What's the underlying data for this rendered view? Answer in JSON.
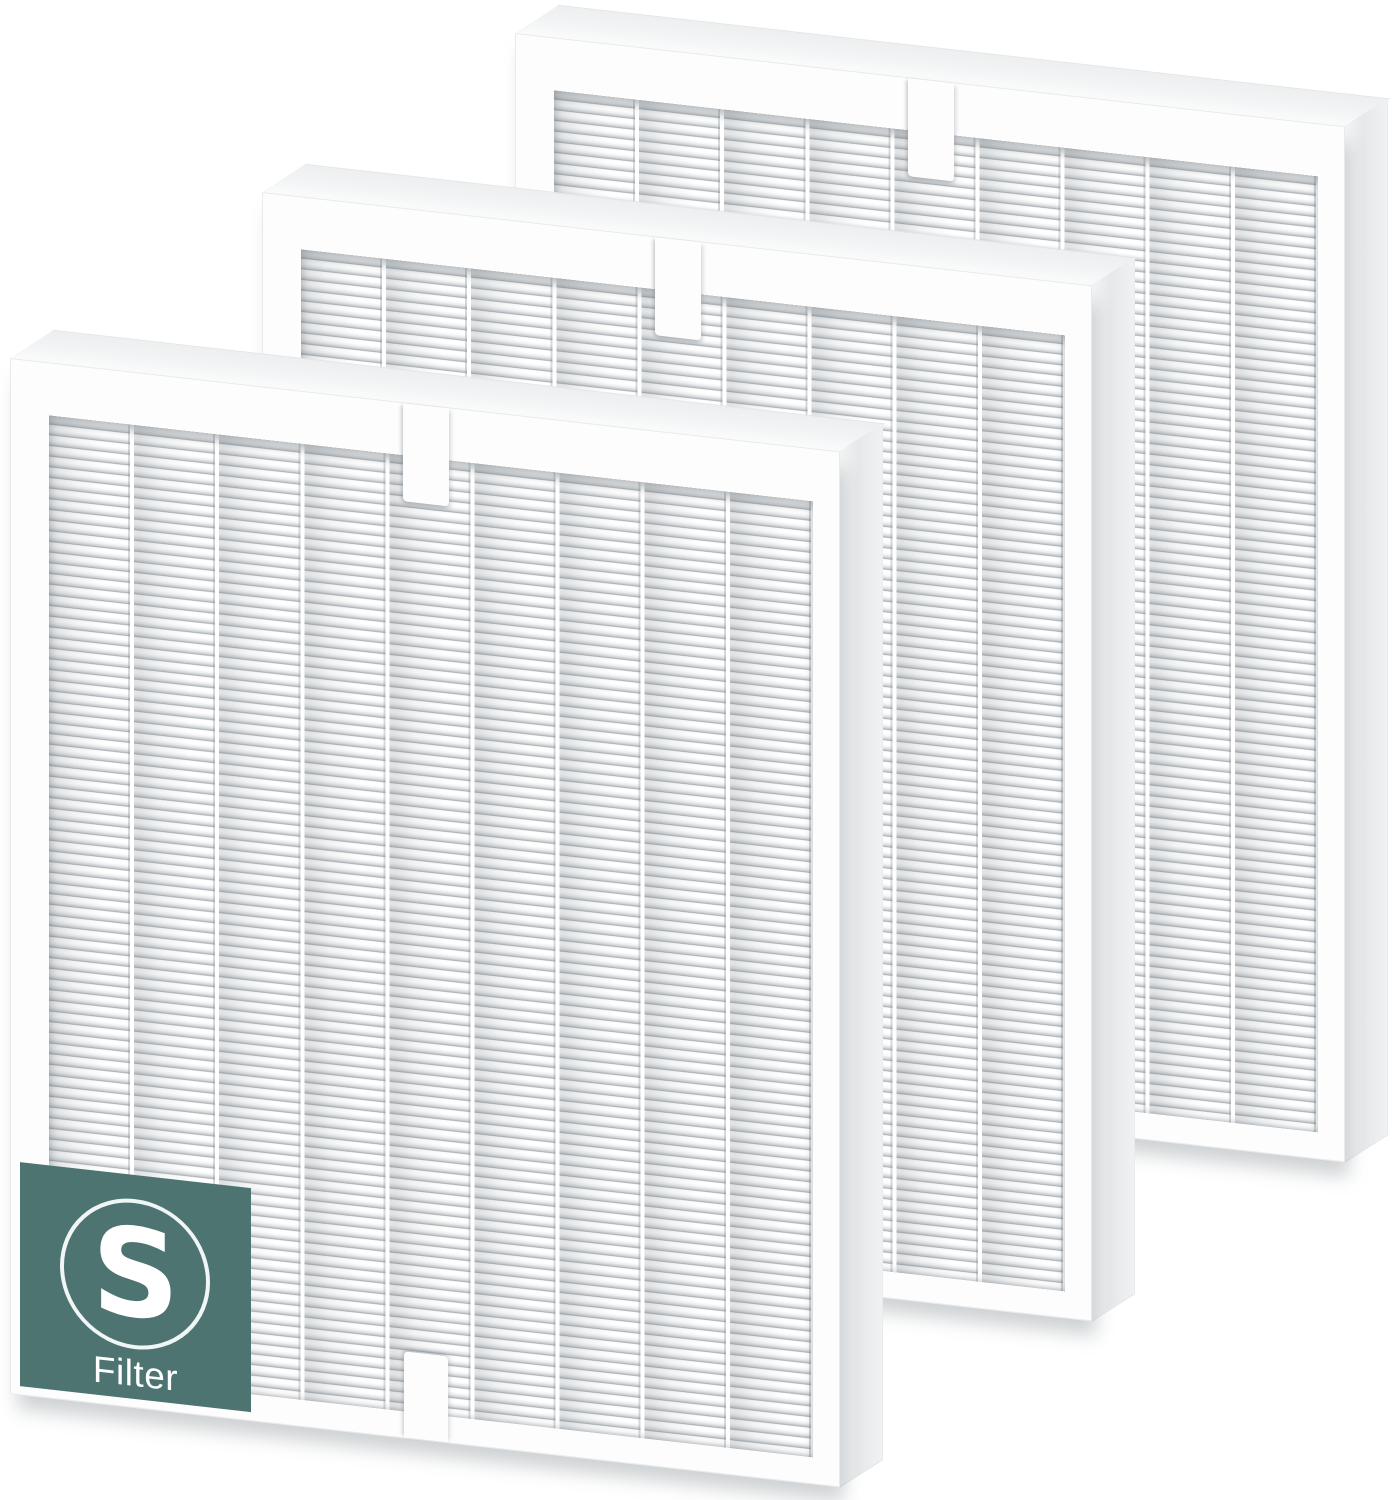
{
  "scene": {
    "background_color": "#ffffff",
    "filters": [
      {
        "position": "back"
      },
      {
        "position": "middle"
      },
      {
        "position": "front"
      }
    ]
  },
  "badge": {
    "letter": "S",
    "label": "Filter",
    "background_color": "#4d7471",
    "text_color": "#ffffff"
  },
  "filter_appearance": {
    "frame_color": "#fdfdfe",
    "top_face_color": "#f1f3f4",
    "side_face_color": "#e6e8ea",
    "pleat_highlight_color": "#ffffff",
    "pleat_shadow_color": "#a8aeb2",
    "pleat_columns": 9
  }
}
